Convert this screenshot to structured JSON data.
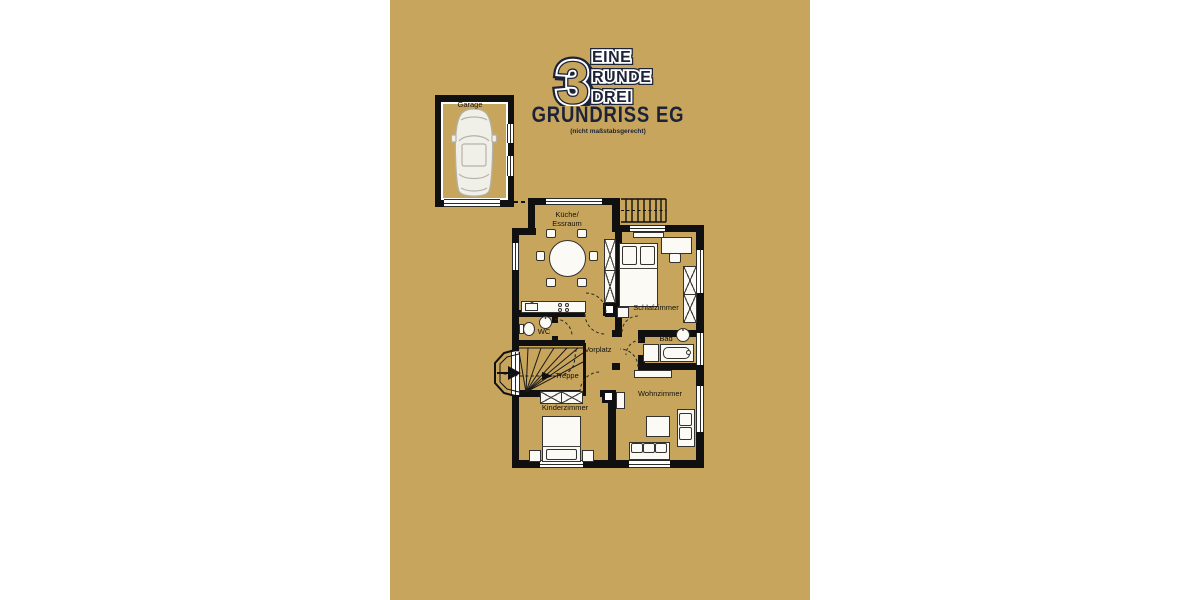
{
  "panel": {
    "gold": "#C8A55C",
    "navy": "#1C2338"
  },
  "logo": {
    "digit": "3",
    "words": [
      "EINE",
      "RUNDE",
      "DREI"
    ],
    "title": "GRUNDRISS EG",
    "subtitle": "(nicht maßstabsgerecht)"
  },
  "plan": {
    "labels": {
      "garage": "Garage",
      "kitchen_line1": "Küche/",
      "kitchen_line2": "Essraum",
      "wc": "WC",
      "hall": "Vorplatz",
      "stairs": "Treppe",
      "bath": "Bad",
      "bedroom": "Schlafzimmer",
      "living": "Wohnzimmer",
      "kids": "Kinderzimmer"
    }
  }
}
